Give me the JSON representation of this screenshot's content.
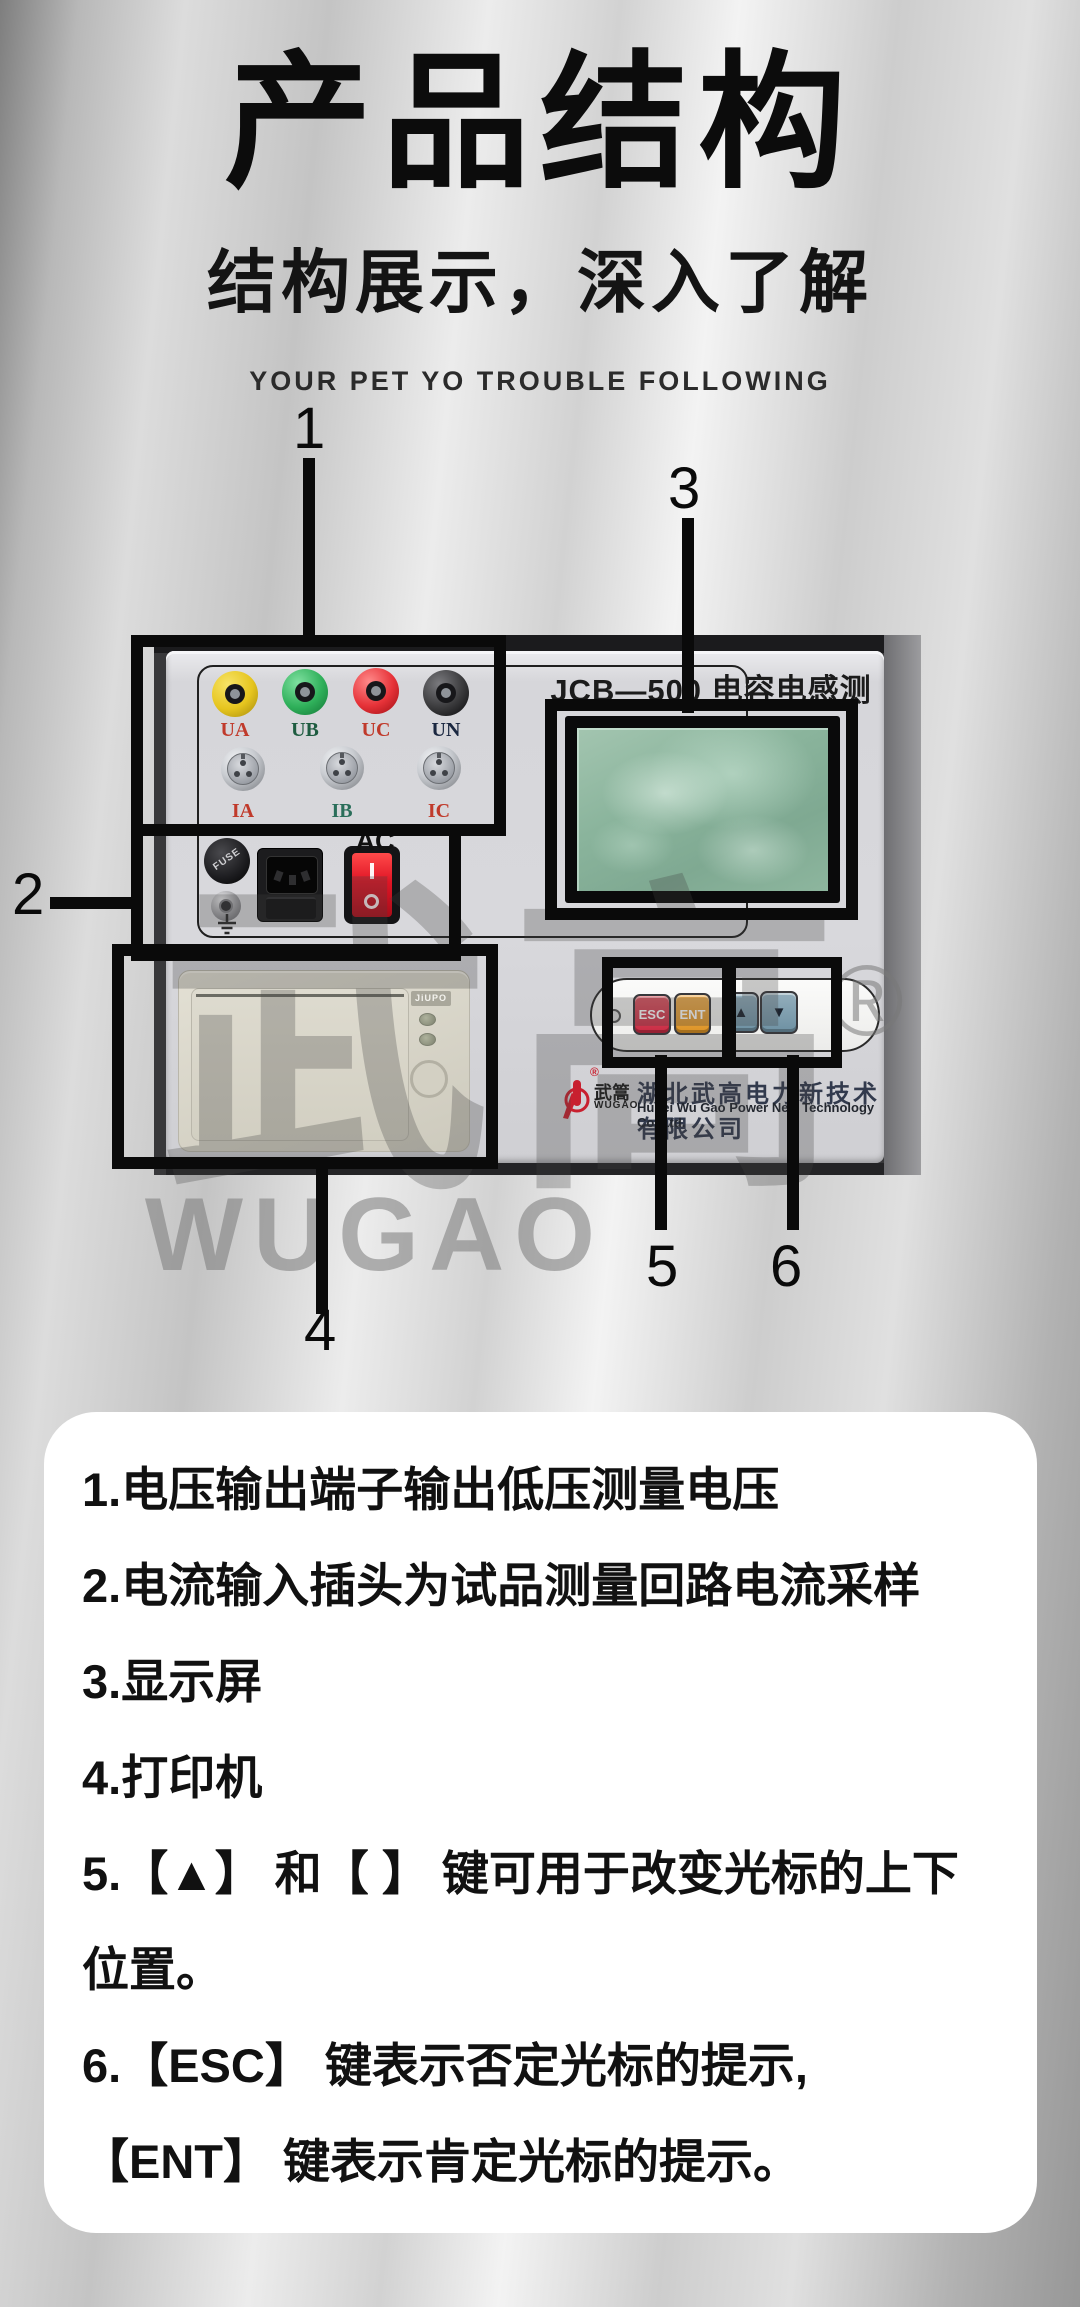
{
  "header": {
    "title": "产品结构",
    "subtitle": "结构展示，深入了解",
    "tagline": "YOUR PET YO TROUBLE FOLLOWING"
  },
  "device": {
    "model_label": "JCB—500 电容电感测试仪",
    "voltage_terminals": [
      {
        "label": "UA"
      },
      {
        "label": "UB"
      },
      {
        "label": "UC"
      },
      {
        "label": "UN"
      }
    ],
    "current_inputs": [
      {
        "label": "IA"
      },
      {
        "label": "IB"
      },
      {
        "label": "IC"
      }
    ],
    "fuse_label": "FUSE",
    "ac_label": "AC",
    "power_switch": {
      "on_mark": "I",
      "off_mark": "O"
    },
    "printer": {
      "brand_chip": "JiUPO"
    },
    "keypad": {
      "esc": "ESC",
      "ent": "ENT",
      "up": "▲",
      "down": "▼"
    },
    "brand": {
      "logo_cn": "武篙",
      "logo_en": "WUGAO",
      "registered": "®"
    },
    "company_cn": "湖北武高电力新技术有限公司",
    "company_en": "Hubei Wu Gao Power New Technology Co.,Ltd.",
    "watermark": {
      "cn": "武高",
      "en": "WUGAO",
      "registered": "®"
    }
  },
  "callouts": {
    "labels": [
      "1",
      "2",
      "3",
      "4",
      "5",
      "6"
    ]
  },
  "notes": [
    "1.电压输出端子输出低压测量电压",
    "2.电流输入插头为试品测量回路电流采样",
    "3.显示屏",
    "4.打印机",
    "5.【▲】 和【 】 键可用于改变光标的上下位置。",
    "6.【ESC】 键表示否定光标的提示,【ENT】 键表示肯定光标的提示。"
  ],
  "colors": {
    "esc_key": "#c92b44",
    "ent_key": "#dd9426",
    "arrow_keys": "#6e91a3",
    "rocker_switch": "#e01525",
    "lcd_green": "#8ab49c",
    "terminal_yellow": "#e6c51e",
    "terminal_green": "#2fb05a",
    "terminal_red": "#e63238",
    "terminal_black": "#3a3a3c",
    "callout": "#0a0a0a"
  }
}
